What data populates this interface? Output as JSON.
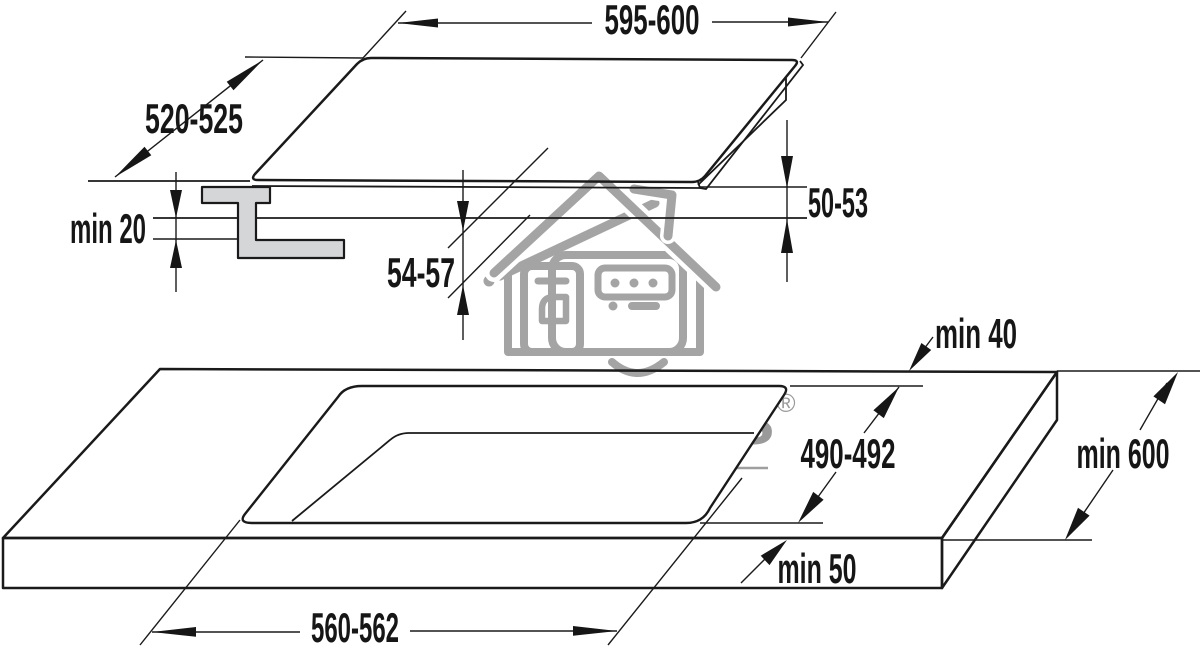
{
  "diagram": {
    "kind": "built-in hob installation drawing",
    "dims": {
      "hob_width": "595-600",
      "hob_depth": "520-525",
      "hob_height_total": "54-57",
      "hob_height_below_worktop": "50-53",
      "clearance_below": "min 20",
      "cutout_width": "560-562",
      "cutout_depth": "490-492",
      "cutout_to_back_edge": "min 40",
      "cutout_to_front_edge": "min 50",
      "worktop_min_depth": "min 600"
    }
  },
  "watermark": {
    "brand": "Mart Maks",
    "registered": "®",
    "tagline": "ONLINE STORE"
  },
  "colors": {
    "line": "#1a1a1a",
    "bracket_fill": "#d5d6d8",
    "watermark_gray": "#9a9a9a"
  }
}
